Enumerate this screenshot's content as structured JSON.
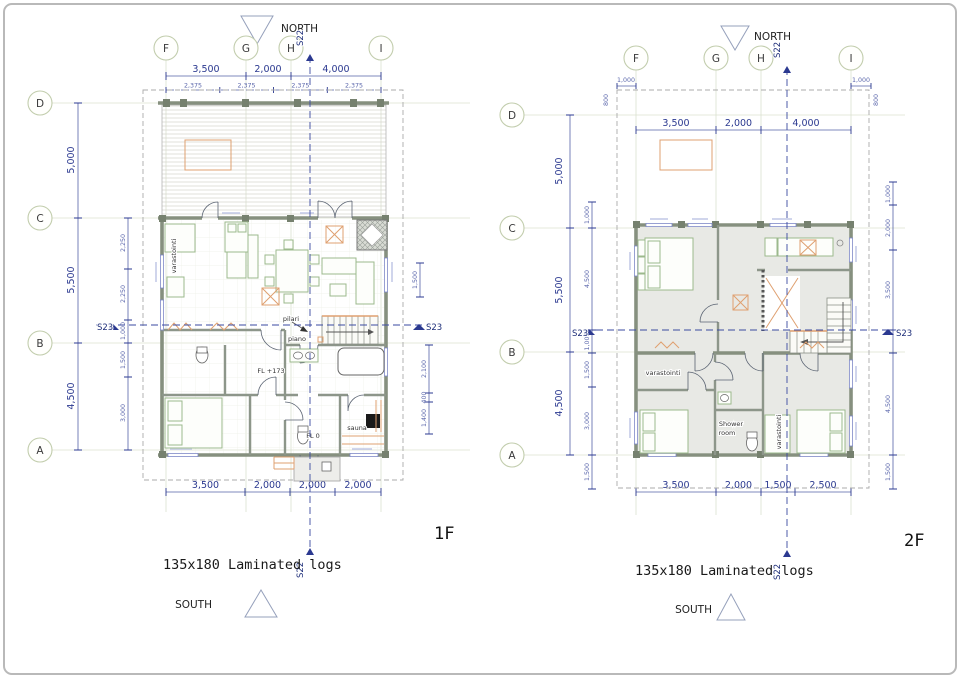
{
  "sheet": {
    "north_label": "NORTH",
    "south_label": "SOUTH",
    "s22_label": "S22",
    "s23_label": "S23",
    "logs_note": "135x180 Laminated logs"
  },
  "grid": {
    "cols": [
      "F",
      "G",
      "H",
      "I"
    ],
    "rows": [
      "D",
      "C",
      "B",
      "A"
    ]
  },
  "colors": {
    "dimension_blue": "#2b3990",
    "wall_gray_green": "#86907f",
    "furniture_green": "#9cb98c",
    "furniture_orange": "#dfa070",
    "floor_gray": "#e8e9e5",
    "grid_line": "#dbe1cf",
    "section_blue": "#3a4aa0",
    "stove_black": "#1a1a1a"
  },
  "plan1f": {
    "title": "1F",
    "top_dims": [
      "3,500",
      "2,000",
      "4,000"
    ],
    "sub_dims": [
      "2,375",
      "2,375",
      "2,375",
      "2,375"
    ],
    "left_dims": [
      "5,000",
      "5,500",
      "4,500"
    ],
    "left_inner_dims": [
      "2,250",
      "2,250",
      "1,000",
      "1,500",
      "3,000"
    ],
    "right_dims": [
      "1,500",
      "2,100",
      "400",
      "1,400"
    ],
    "bottom_dims": [
      "3,500",
      "2,000",
      "2,000",
      "2,000"
    ],
    "labels": {
      "storage": "varastointi",
      "floor_level_main": "FL +173",
      "floor_level_entry": "FL 0",
      "sauna": "sauna",
      "piano": "piano",
      "pillar": "pilari"
    }
  },
  "plan2f": {
    "title": "2F",
    "top_dims": [
      "3,500",
      "2,000",
      "4,000"
    ],
    "offset_dim": "1,000",
    "eave_dim": "800",
    "left_dims": [
      "5,000",
      "5,500",
      "4,500"
    ],
    "left_inner_dims": [
      "1,000",
      "4,500",
      "1,000",
      "1,500",
      "3,000",
      "1,500"
    ],
    "right_dims": [
      "1,000",
      "2,000",
      "3,500",
      "4,500",
      "1,500"
    ],
    "bottom_dims": [
      "3,500",
      "2,000",
      "1,500",
      "2,500"
    ],
    "labels": {
      "storage": "varastointi",
      "storage2": "varastointi",
      "shower_line1": "Shower",
      "shower_line2": "room"
    }
  }
}
